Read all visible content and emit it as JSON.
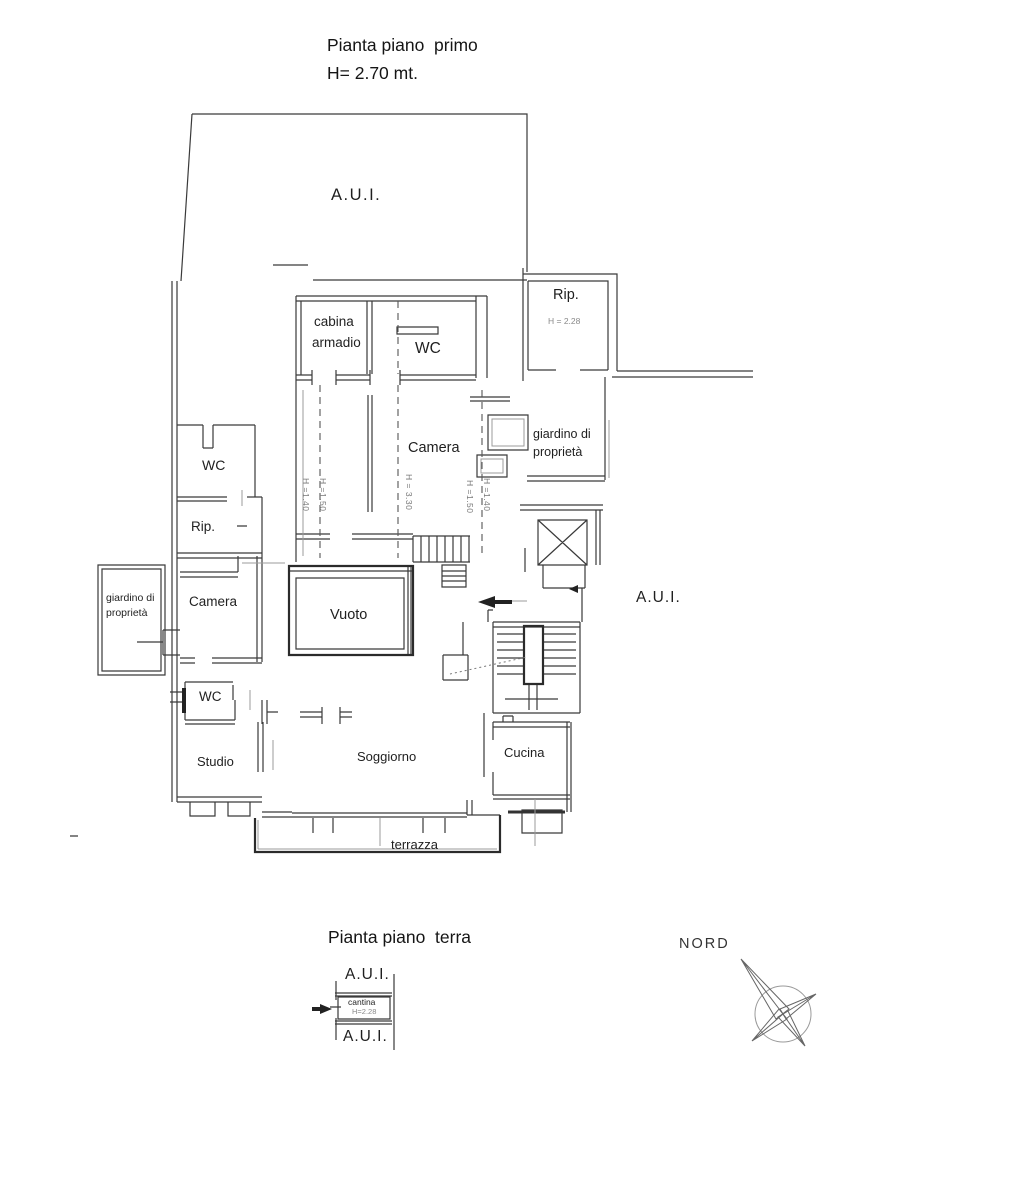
{
  "plan_upper": {
    "title": "Pianta piano  primo",
    "subtitle": "H= 2.70 mt.",
    "rooms": {
      "aui_top": "A.U.I.",
      "rip": "Rip.",
      "rip_h": "H = 2.28",
      "cabina1": "cabina",
      "cabina2": "armadio",
      "wc_top": "WC",
      "camera": "Camera",
      "giardino_right1": "giardino di",
      "giardino_right2": "proprietà",
      "wc_left": "WC",
      "rip_left": "Rip.",
      "giardino_left1": "giardino di",
      "giardino_left2": "proprietà",
      "camera_left": "Camera",
      "vuoto": "Vuoto",
      "aui_right": "A.U.I.",
      "wc_lower": "WC",
      "studio": "Studio",
      "soggiorno": "Soggiorno",
      "cucina": "Cucina",
      "terrazza": "terrazza"
    },
    "height_marks": {
      "m1": "H =1.40",
      "m2": "H =1.50",
      "m3": "H = 3.30",
      "m4": "H =1.50",
      "m5": "H =1.40"
    }
  },
  "plan_lower": {
    "title": "Pianta piano  terra",
    "aui_upper": "A.U.I.",
    "cantina": "cantina",
    "cantina_h": "H=2.28",
    "aui_lower": "A.U.I."
  },
  "compass": {
    "label": "NORD"
  },
  "colors": {
    "line": "#3a3a3a",
    "light_line": "#999999",
    "dark": "#222222"
  }
}
